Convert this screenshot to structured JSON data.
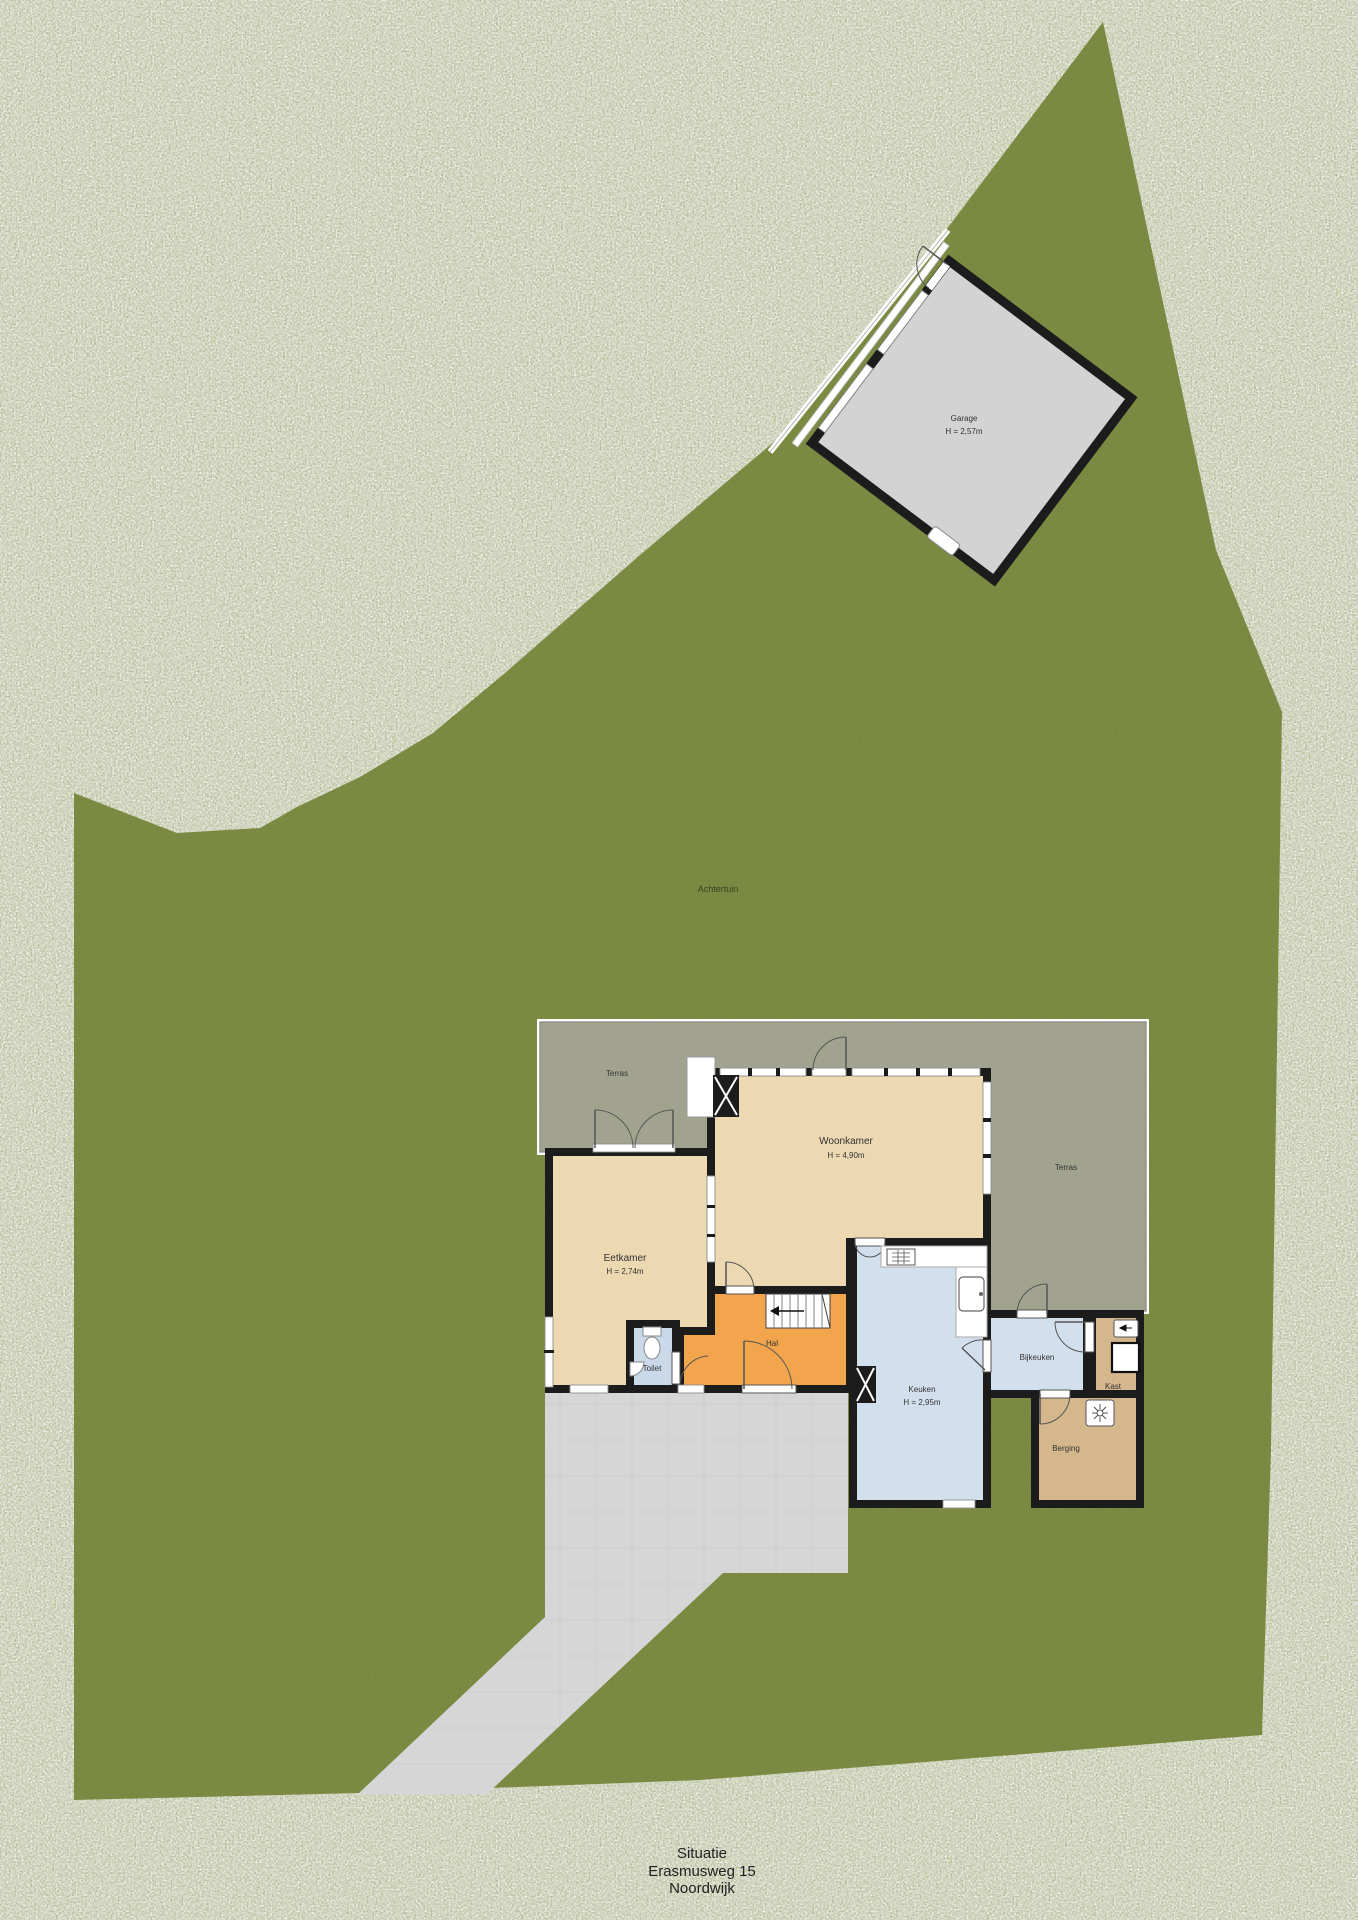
{
  "plan": {
    "caption": {
      "line1": "Situatie",
      "line2": "Erasmusweg 15",
      "line3": "Noordwijk"
    },
    "garden": {
      "back_label": "Achtertuin"
    },
    "rooms": {
      "garage": {
        "name": "Garage",
        "height": "H = 2,57m"
      },
      "terras_left": {
        "name": "Terras"
      },
      "terras_right": {
        "name": "Terras"
      },
      "woonkamer": {
        "name": "Woonkamer",
        "height": "H = 4,90m"
      },
      "eetkamer": {
        "name": "Eetkamer",
        "height": "H = 2,74m"
      },
      "toilet": {
        "name": "Toilet"
      },
      "hal": {
        "name": "Hal"
      },
      "keuken": {
        "name": "Keuken",
        "height": "H = 2,95m"
      },
      "bijkeuken": {
        "name": "Bijkeuken"
      },
      "kast": {
        "name": "Kast"
      },
      "berging": {
        "name": "Berging"
      }
    },
    "colors": {
      "grass": "#7d8e44",
      "terrace": "#a1a38f",
      "living_rooms": "#ecd9b1",
      "hall": "#f3a54d",
      "wet_rooms": "#d2e0ee",
      "storage": "#d5b78e",
      "garage": "#d3d3d3",
      "driveway": "#d6d6d6",
      "walls": "#1c1c1c"
    }
  }
}
